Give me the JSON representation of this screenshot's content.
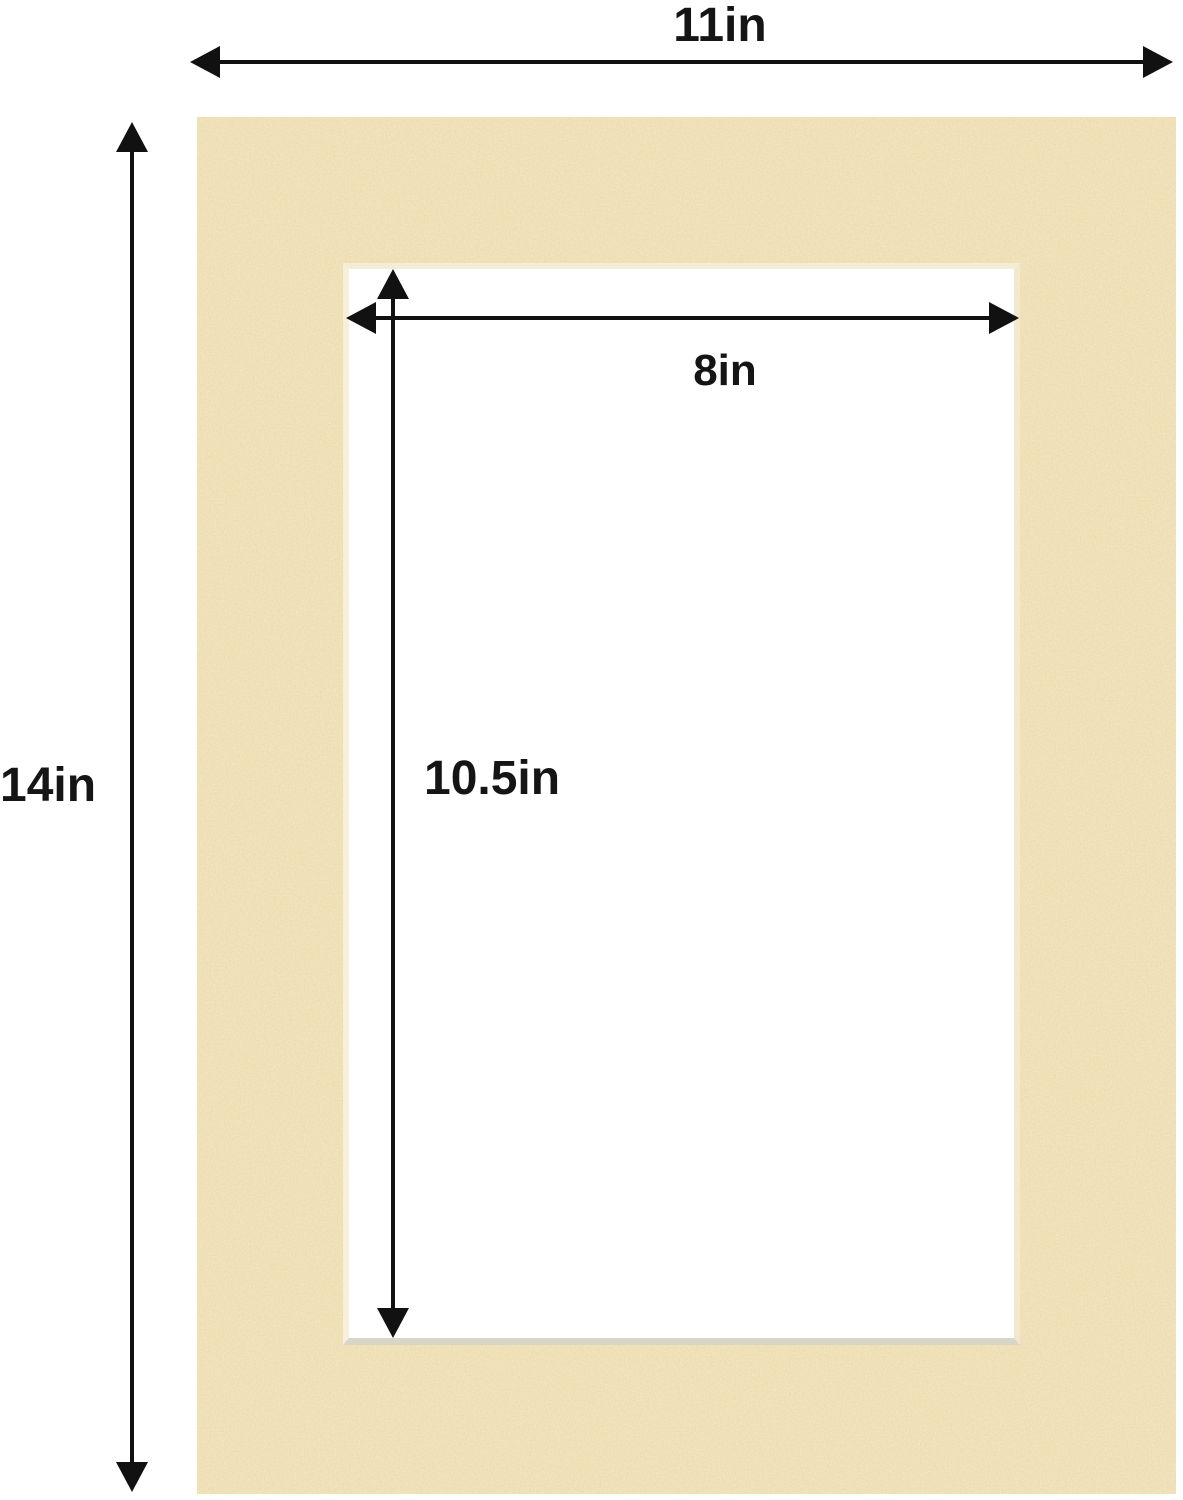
{
  "figure": {
    "mat": {
      "color": "#ecd9a6",
      "opening_color": "#ffffff",
      "bevel_bottom_color": "#d9d5c7"
    },
    "arrow_color": "#111111",
    "dimensions": {
      "outer_width": "11in",
      "outer_height": "14in",
      "opening_width": "8in",
      "opening_height": "10.5in"
    }
  }
}
